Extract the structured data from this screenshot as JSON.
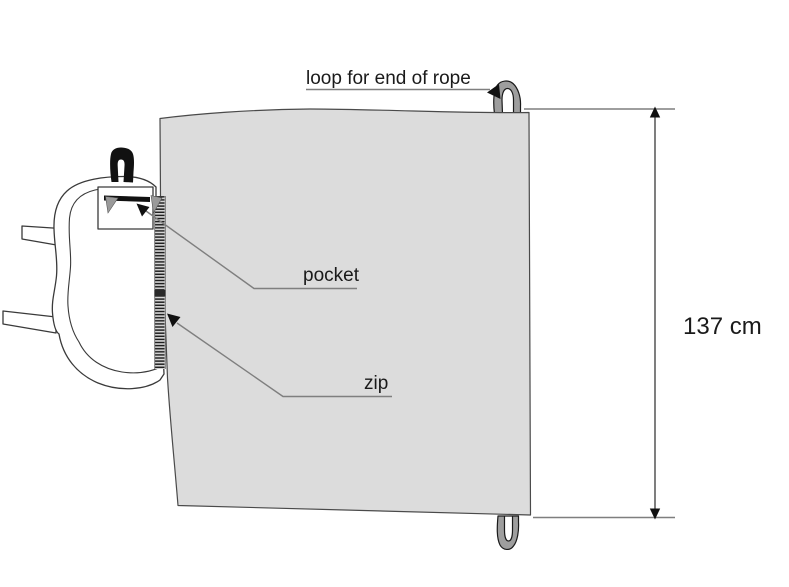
{
  "diagram": {
    "background": "#ffffff",
    "labels": {
      "rope_loop": "loop for end of rope",
      "pocket": "pocket",
      "zip": "zip"
    },
    "dimension": {
      "text": "137 cm",
      "value": 137,
      "unit": "cm"
    },
    "colors": {
      "sheet_fill": "#dcdcdc",
      "webbing_loop_fill": "#9e9e9e",
      "outline": "#3a3a3a",
      "leader_line": "#7f7f7f",
      "arrow": "#111111",
      "text": "#1a1a1a"
    },
    "parts": [
      "sheet",
      "zip-strip",
      "rucksack",
      "pocket",
      "rope-loop-top",
      "rope-loop-bottom",
      "shoulder-strap-stubs"
    ]
  }
}
